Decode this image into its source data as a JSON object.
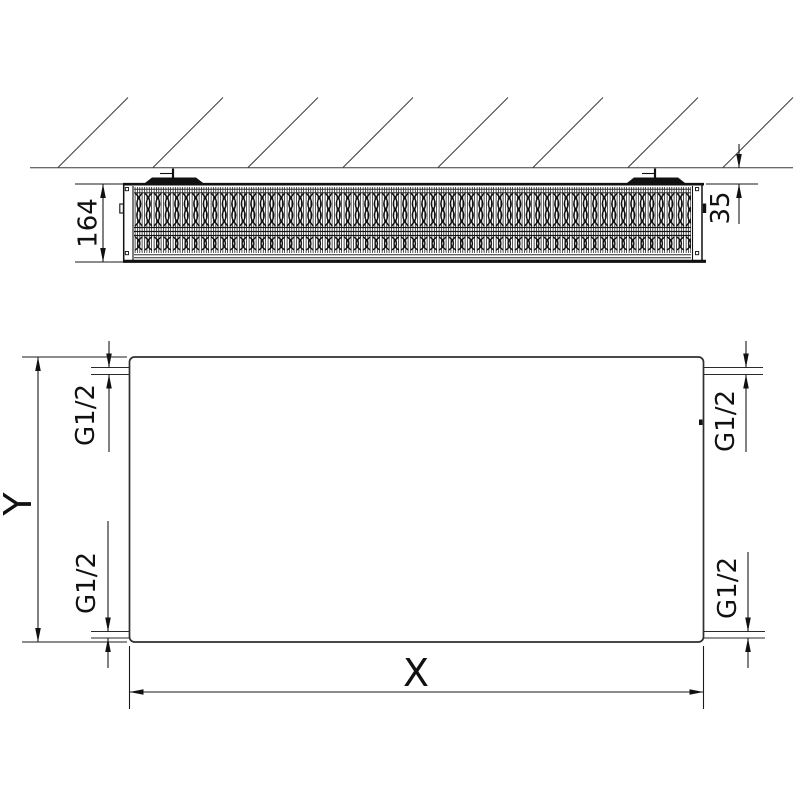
{
  "drawing": {
    "background_color": "#ffffff",
    "line_color": "#1a1a1a",
    "top_view": {
      "depth_label": "164",
      "wall_distance_label": "35"
    },
    "front_view": {
      "width_label": "X",
      "height_label": "Y",
      "connections": {
        "top_left": "G1/2",
        "top_right": "G1/2",
        "bottom_left": "G1/2",
        "bottom_right": "G1/2"
      }
    }
  }
}
